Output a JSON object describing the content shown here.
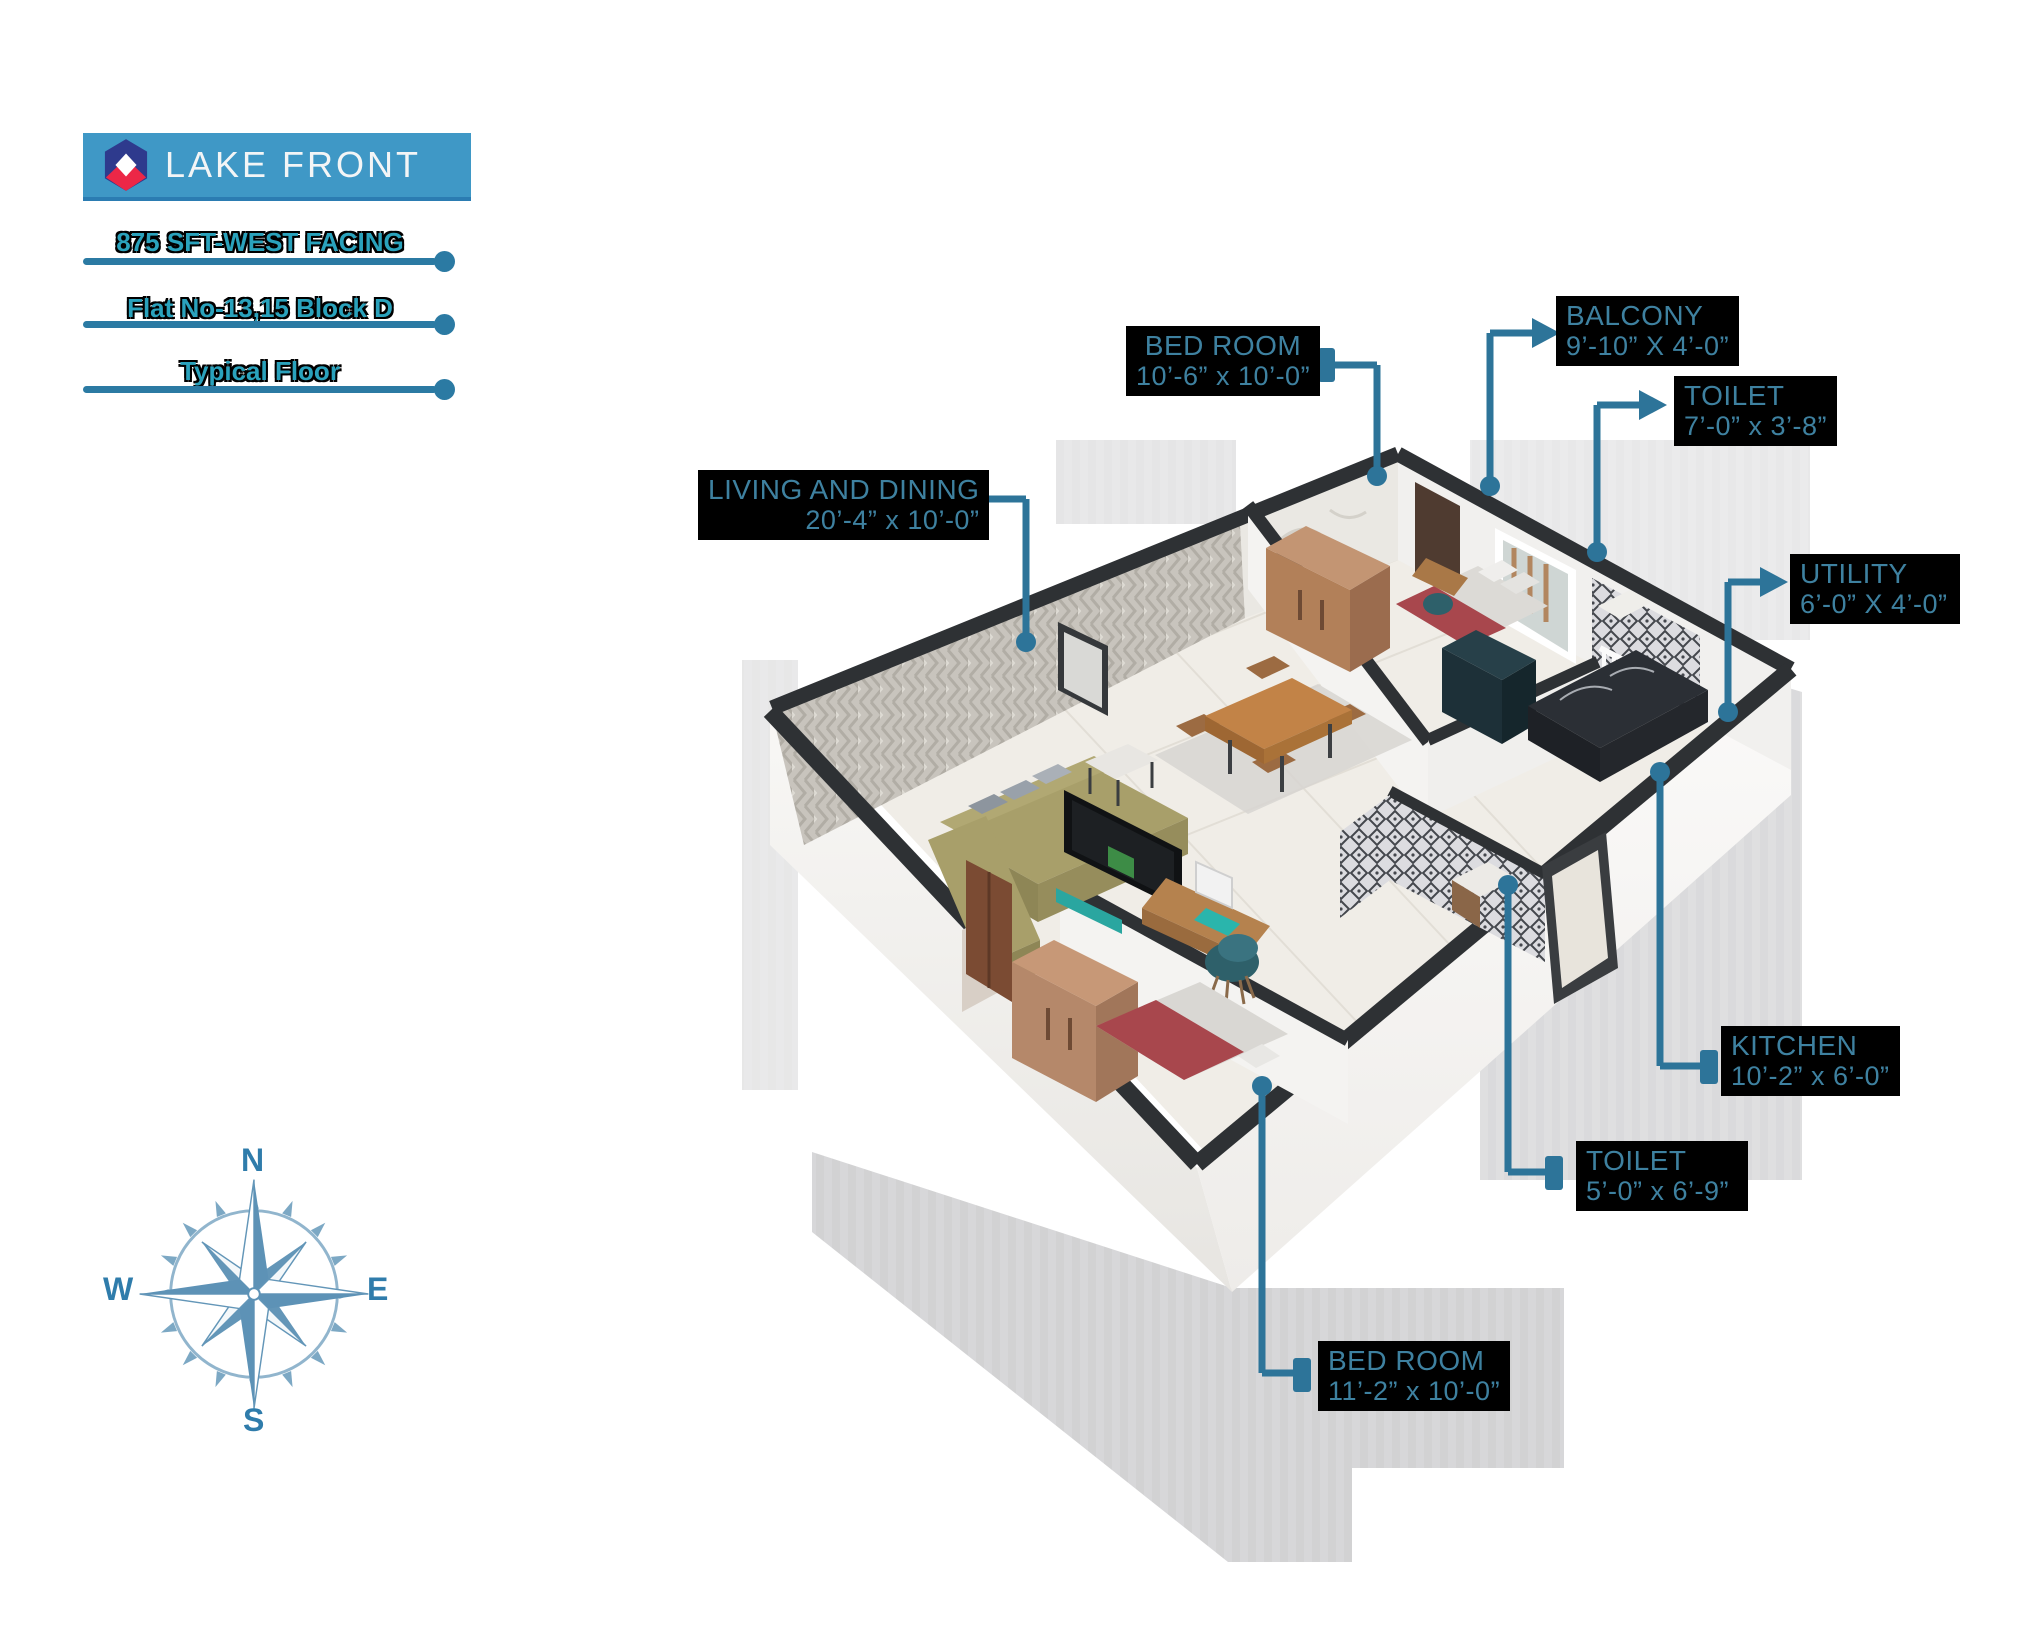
{
  "brand": {
    "title": "LAKE FRONT"
  },
  "header": {
    "lines": [
      "875 SFT-WEST FACING",
      "Flat No-13,15 Block D",
      "Typical Floor"
    ]
  },
  "labels": [
    {
      "id": "living",
      "name": "LIVING AND DINING",
      "dims": "20’-4” x 10’-0”"
    },
    {
      "id": "bedroom-top",
      "name": "BED ROOM",
      "dims": "10’-6” x 10’-0”"
    },
    {
      "id": "balcony",
      "name": "BALCONY",
      "dims": "9’-10” X 4’-0”"
    },
    {
      "id": "toilet-top",
      "name": "TOILET",
      "dims": "7’-0” x 3’-8”"
    },
    {
      "id": "utility",
      "name": "UTILITY",
      "dims": "6’-0” X 4’-0”"
    },
    {
      "id": "kitchen",
      "name": "KITCHEN",
      "dims": "10’-2” x 6’-0”"
    },
    {
      "id": "toilet-bottom",
      "name": "TOILET",
      "dims": "5’-0” x 6’-9”"
    },
    {
      "id": "bedroom-bottom",
      "name": "BED ROOM",
      "dims": "11’-2” x 10’-0”"
    }
  ],
  "compass": {
    "n": "N",
    "e": "E",
    "s": "S",
    "w": "W"
  },
  "colors": {
    "banner_blue": "#3f98c6",
    "logo_navy": "#2e3a8d",
    "logo_red": "#ec2747",
    "header_teal": "#2aa2bc",
    "label_teal": "#3e81a0",
    "label_bg": "#000000",
    "leader_blue": "#2d7499",
    "wall_top_dark": "#2e3134",
    "floor_tile": "#f0ede7",
    "sofa_olive": "#a89f6a",
    "bed_red": "#a8474d",
    "wardrobe_brown": "#b5886a",
    "wood_table": "#c28347",
    "chair_teal": "#2e606a",
    "compass_blue": "#5d92b6",
    "shadow_gray": "#b0b0b3"
  }
}
